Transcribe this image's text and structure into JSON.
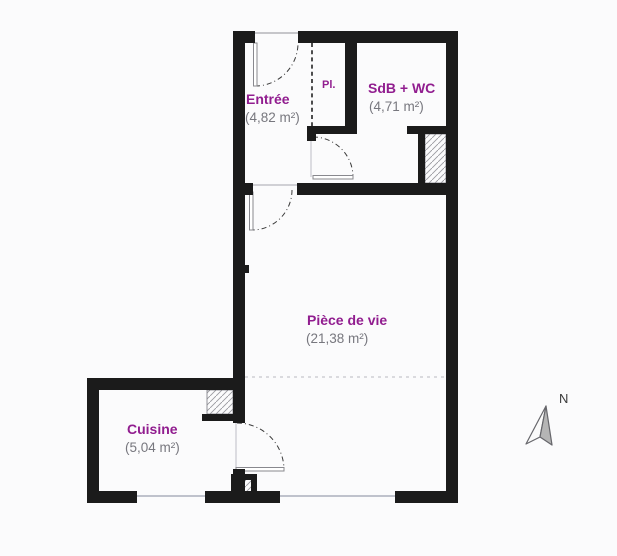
{
  "plan": {
    "rooms": [
      {
        "id": "entree",
        "name": "Entrée",
        "area": "(4,82 m²)"
      },
      {
        "id": "sdb-wc",
        "name": "SdB + WC",
        "area": "(4,71 m²)"
      },
      {
        "id": "placard",
        "name": "Pl.",
        "area": ""
      },
      {
        "id": "piece-de-vie",
        "name": "Pièce de vie",
        "area": "(21,38 m²)"
      },
      {
        "id": "cuisine",
        "name": "Cuisine",
        "area": "(5,04 m²)"
      }
    ],
    "compass": {
      "label": "N"
    },
    "colors": {
      "wall": "#1b1b1b",
      "room_label": "#911d8f",
      "area_label": "#77777e",
      "background": "#fbfbfc",
      "hatch_line": "#9a9aa0",
      "window_line": "#bfc2cc",
      "door_arc": "#3a3a3a",
      "compass_fill": "#b5b5b5"
    }
  }
}
